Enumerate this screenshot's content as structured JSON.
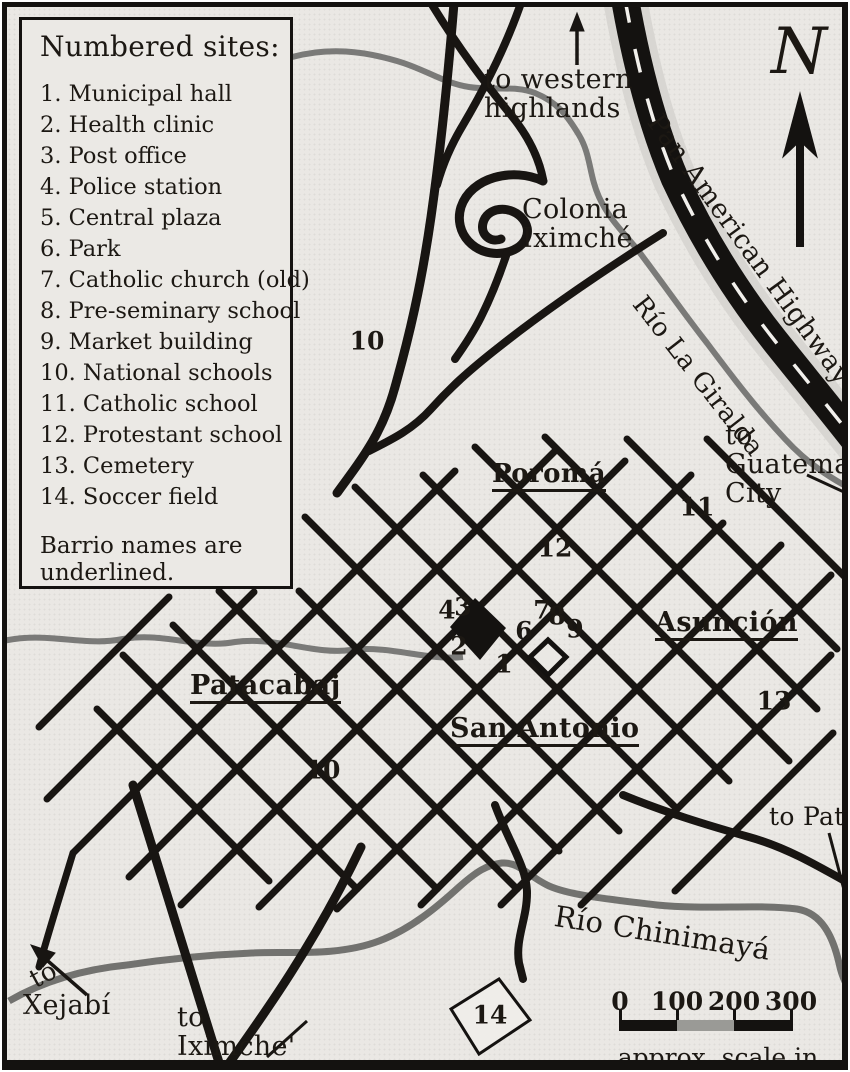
{
  "title": "Town map with numbered sites",
  "colors": {
    "paper": "#eae8e4",
    "ink": "#141210",
    "river": "#7a7a78",
    "highway_halo": "#d8d6d2"
  },
  "legend": {
    "title": "Numbered sites:",
    "items": [
      {
        "num": "1.",
        "label": "Municipal hall"
      },
      {
        "num": "2.",
        "label": "Health clinic"
      },
      {
        "num": "3.",
        "label": "Post office"
      },
      {
        "num": "4.",
        "label": "Police station"
      },
      {
        "num": "5.",
        "label": "Central plaza"
      },
      {
        "num": "6.",
        "label": "Park"
      },
      {
        "num": "7.",
        "label": "Catholic church (old)"
      },
      {
        "num": "8.",
        "label": "Pre-seminary school"
      },
      {
        "num": "9.",
        "label": "Market building"
      },
      {
        "num": "10.",
        "label": "National schools"
      },
      {
        "num": "11.",
        "label": "Catholic school"
      },
      {
        "num": "12.",
        "label": "Protestant school"
      },
      {
        "num": "13.",
        "label": "Cemetery"
      },
      {
        "num": "14.",
        "label": "Soccer field"
      }
    ],
    "note": "Barrio names are underlined."
  },
  "compass_letter": "N",
  "map_labels": [
    {
      "id": "to-western-highlands",
      "lines": [
        "to western",
        "highlands"
      ],
      "x": 477,
      "y": 58,
      "size": 27
    },
    {
      "id": "colonia-iximche",
      "lines": [
        "Colonia",
        "Iximché"
      ],
      "x": 515,
      "y": 188,
      "size": 27
    },
    {
      "id": "to-guatemala-city",
      "lines": [
        "to",
        "Guatemala",
        "City"
      ],
      "x": 718,
      "y": 414,
      "size": 27
    },
    {
      "id": "to-patzu",
      "lines": [
        "to Patzú"
      ],
      "x": 762,
      "y": 796,
      "size": 25
    },
    {
      "id": "to-xejabi-to",
      "lines": [
        "to"
      ],
      "x": 18,
      "y": 962,
      "size": 26,
      "rotate": -28
    },
    {
      "id": "to-xejabi",
      "lines": [
        "Xejabí"
      ],
      "x": 16,
      "y": 984,
      "size": 27
    },
    {
      "id": "to-iximche",
      "lines": [
        "to",
        "Iximche'"
      ],
      "x": 170,
      "y": 996,
      "size": 27
    }
  ],
  "rotated_labels": [
    {
      "id": "pan-american-highway",
      "text": "Pan American Highway",
      "x": 658,
      "y": 102,
      "rotate": 54,
      "size": 27
    },
    {
      "id": "rio-la-giralda",
      "text": "Río La Giralda",
      "x": 642,
      "y": 284,
      "rotate": 52,
      "size": 26
    },
    {
      "id": "rio-chinimaya",
      "text": "Río Chinimayá",
      "x": 550,
      "y": 894,
      "rotate": 9,
      "size": 29
    }
  ],
  "barrios": [
    {
      "name": "Poromá",
      "x": 485,
      "y": 452,
      "size": 26
    },
    {
      "name": "Asunción",
      "x": 648,
      "y": 600,
      "size": 27
    },
    {
      "name": "Patacabaj",
      "x": 183,
      "y": 663,
      "size": 27
    },
    {
      "name": "San Antonio",
      "x": 443,
      "y": 706,
      "size": 27
    }
  ],
  "site_markers": [
    {
      "n": "10",
      "x": 360,
      "y": 334
    },
    {
      "n": "10",
      "x": 316,
      "y": 763
    },
    {
      "n": "11",
      "x": 690,
      "y": 500
    },
    {
      "n": "12",
      "x": 548,
      "y": 541
    },
    {
      "n": "13",
      "x": 767,
      "y": 694
    },
    {
      "n": "4",
      "x": 440,
      "y": 603
    },
    {
      "n": "3",
      "x": 456,
      "y": 600
    },
    {
      "n": "2",
      "x": 452,
      "y": 639
    },
    {
      "n": "1",
      "x": 497,
      "y": 657
    },
    {
      "n": "6",
      "x": 517,
      "y": 624
    },
    {
      "n": "7",
      "x": 535,
      "y": 603
    },
    {
      "n": "8",
      "x": 550,
      "y": 609
    },
    {
      "n": "9",
      "x": 568,
      "y": 622
    },
    {
      "n": "14",
      "x": 483,
      "y": 1008
    }
  ],
  "scale_bar": {
    "tick_labels": [
      "0",
      "100",
      "200",
      "300"
    ],
    "caption": "approx. scale in meters"
  }
}
